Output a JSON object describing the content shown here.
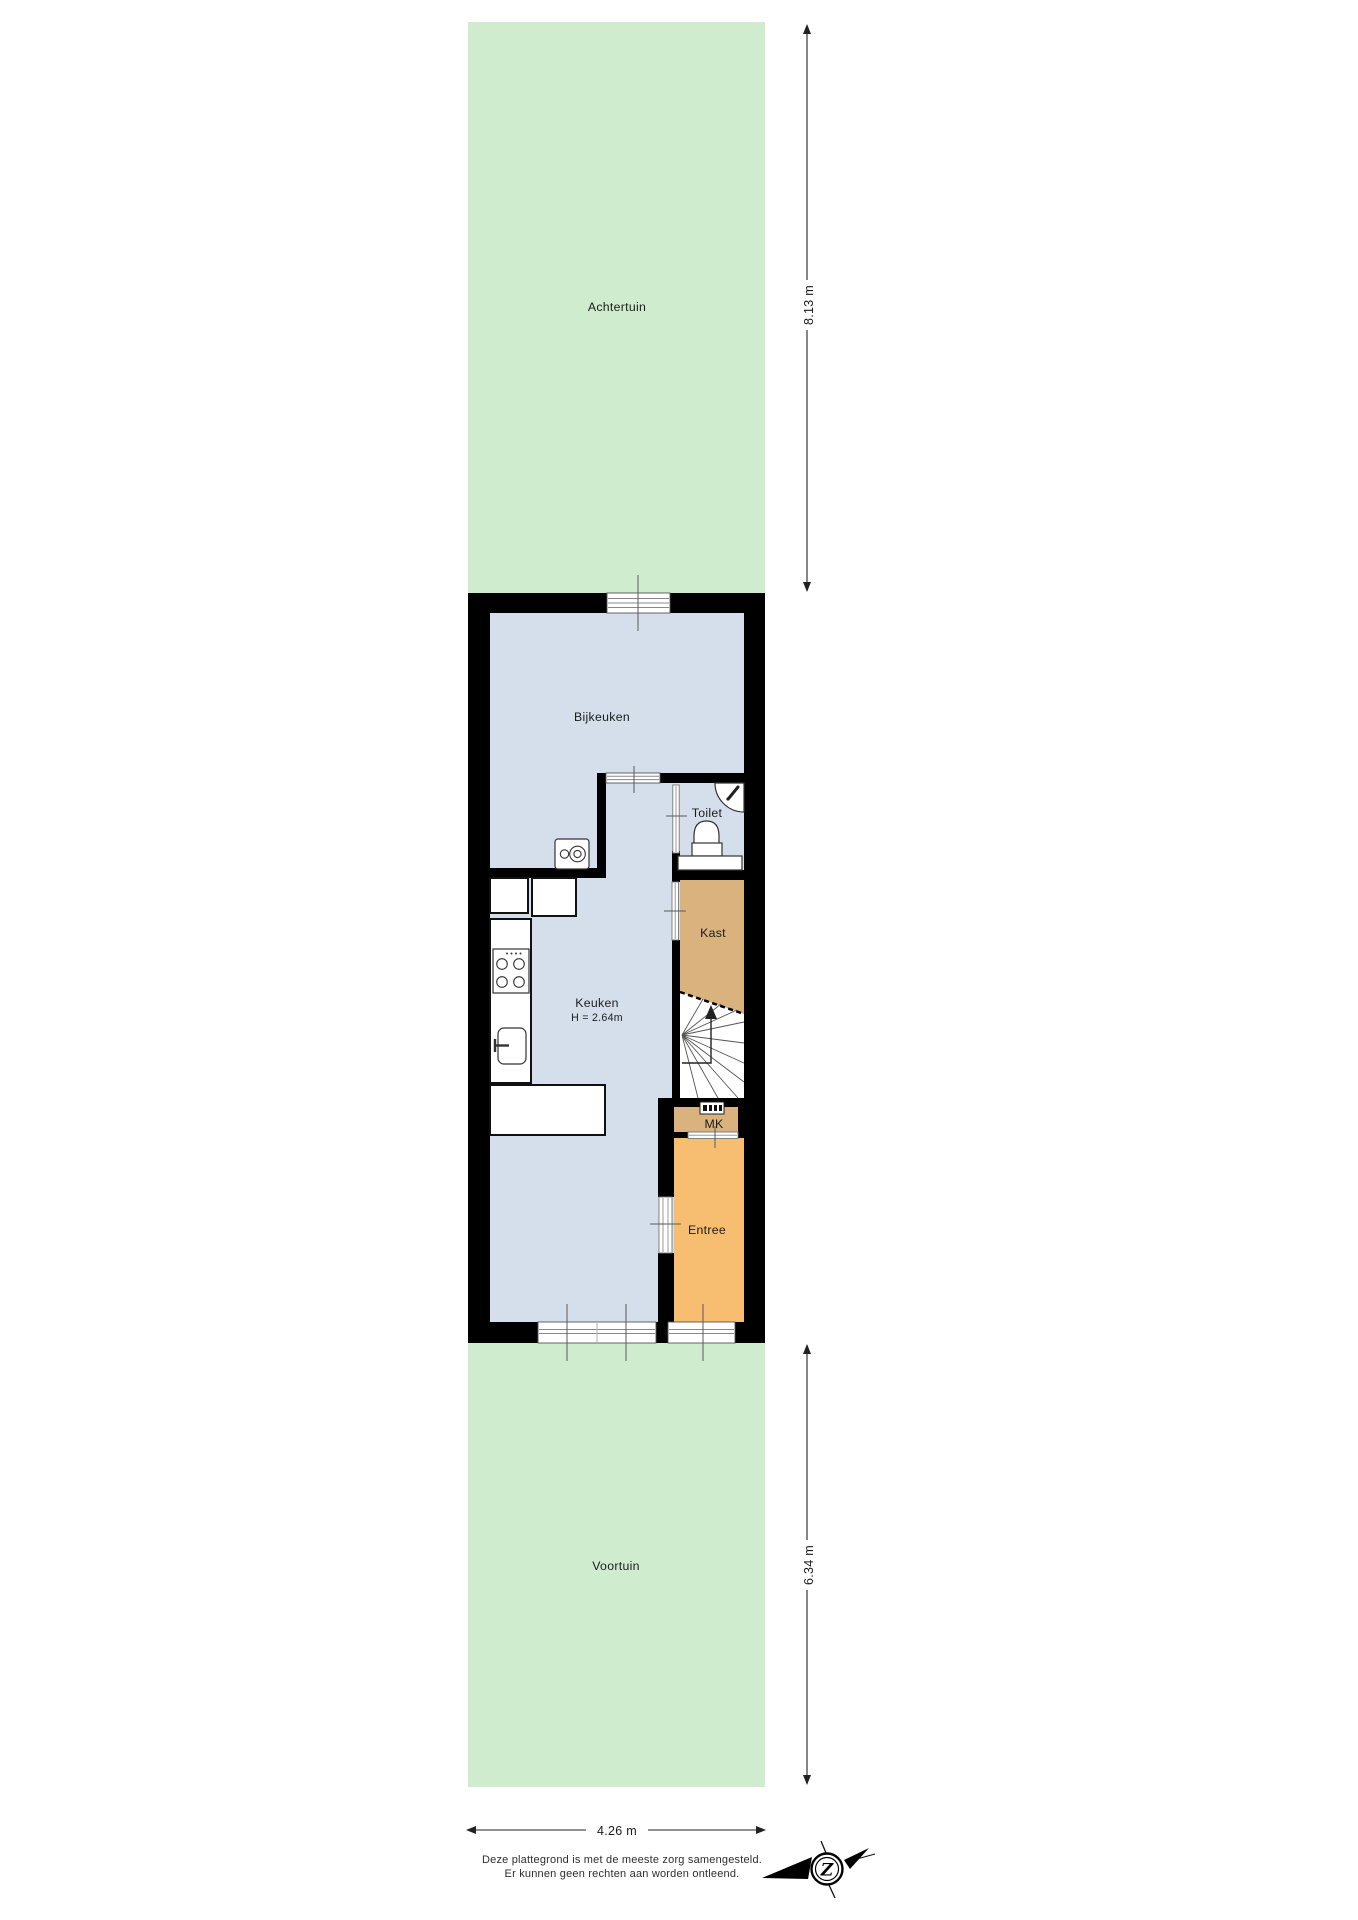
{
  "colors": {
    "garden": "#cfeccf",
    "floor": "#d4dfeb",
    "closet": "#d9b27d",
    "entry": "#f7bd70",
    "wall": "#000000"
  },
  "rooms": {
    "achtertuin": {
      "label": "Achtertuin"
    },
    "bijkeuken": {
      "label": "Bijkeuken"
    },
    "toilet": {
      "label": "Toilet"
    },
    "kast": {
      "label": "Kast"
    },
    "keuken": {
      "label": "Keuken",
      "ceiling_height": "H = 2.64m"
    },
    "mk": {
      "label": "MK"
    },
    "entree": {
      "label": "Entree"
    },
    "voortuin": {
      "label": "Voortuin"
    }
  },
  "dimensions": {
    "achtertuin_depth": "8.13 m",
    "voortuin_depth": "6.34 m",
    "plot_width": "4.26 m"
  },
  "compass": {
    "south_letter": "Z"
  },
  "disclaimer": {
    "line1": "Deze plattegrond is met de meeste zorg samengesteld.",
    "line2": "Er kunnen geen rechten aan worden ontleend."
  }
}
